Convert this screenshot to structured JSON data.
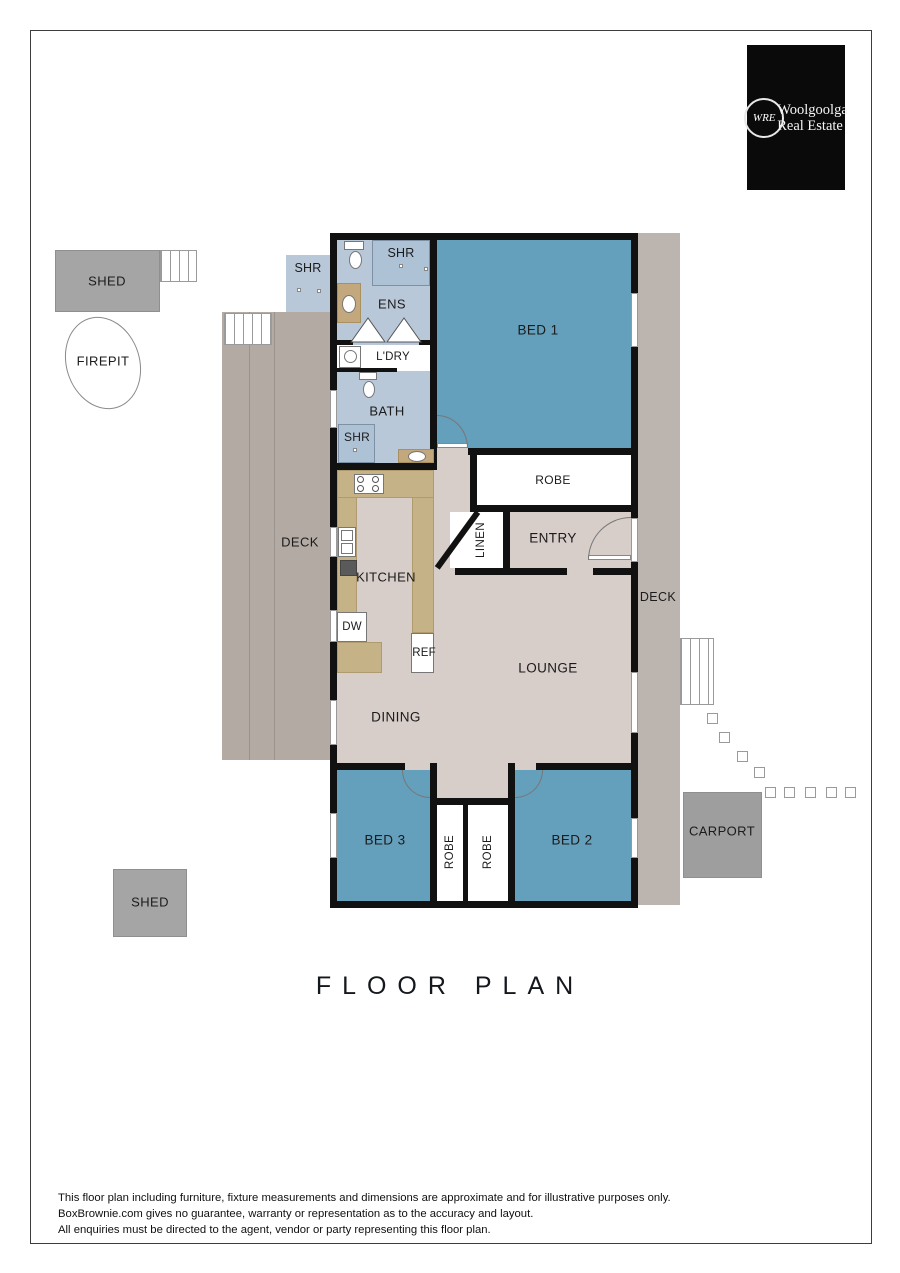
{
  "title": "FLOOR PLAN",
  "logo": {
    "monogram": "WRE",
    "name_line1": "Woolgoolga",
    "name_line2": "Real Estate"
  },
  "rooms": {
    "ens": "ENS",
    "ens_shr": "SHR",
    "outdoor_shr": "SHR",
    "ldry": "L'DRY",
    "bath": "BATH",
    "bath_shr": "SHR",
    "bed1": "BED 1",
    "robe_bed1": "ROBE",
    "linen": "LINEN",
    "entry": "ENTRY",
    "kitchen": "KITCHEN",
    "lounge": "LOUNGE",
    "dining": "DINING",
    "bed3": "BED 3",
    "robe_bed3": "ROBE",
    "robe_bed2": "ROBE",
    "bed2": "BED 2"
  },
  "fixtures": {
    "dw": "DW",
    "ref": "REF"
  },
  "outdoor": {
    "shed_top": "SHED",
    "firepit": "FIREPIT",
    "deck_left": "DECK",
    "deck_right": "DECK",
    "carport": "CARPORT",
    "shed_bottom": "SHED"
  },
  "disclaimer": {
    "line1": "This floor plan including furniture, fixture measurements and dimensions are approximate and for illustrative purposes only.",
    "line2": "BoxBrownie.com gives no guarantee, warranty or representation as to the accuracy and layout.",
    "line3": "All enquiries must be directed to the agent, vendor or party representing this floor plan."
  },
  "colors": {
    "bedroom": "#649fbb",
    "wet_area": "#b9c8d9",
    "floor": "#d7cdc9",
    "counter": "#c6b287",
    "deck": "#b3aaa4",
    "structure_gray": "#a5a5a5",
    "wall": "#111111",
    "logo_background": "#0a0a0a"
  }
}
